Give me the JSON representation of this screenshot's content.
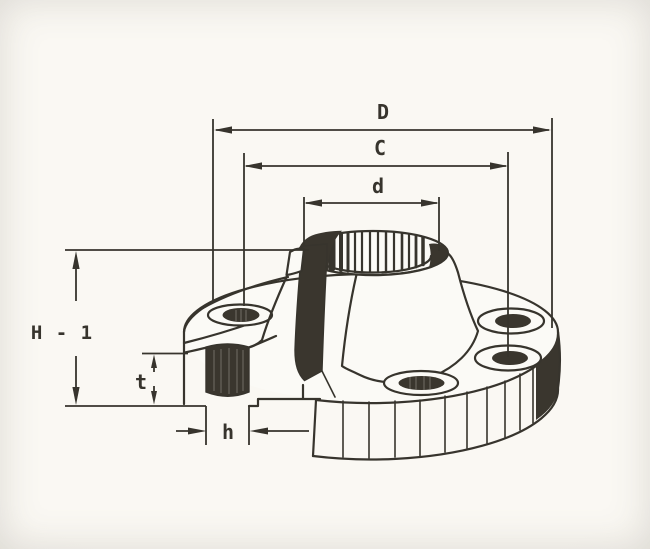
{
  "diagram": {
    "type": "technical-drawing",
    "subject": "flange-isometric-cutaway",
    "dimensions": [
      {
        "id": "D",
        "label": "D"
      },
      {
        "id": "C",
        "label": "C"
      },
      {
        "id": "d",
        "label": "d"
      },
      {
        "id": "H1",
        "label": "H - 1"
      },
      {
        "id": "t",
        "label": "t"
      },
      {
        "id": "h",
        "label": "h"
      }
    ],
    "colors": {
      "background": "#f8f6f0",
      "paper": "#fbfaf6",
      "ink": "#37342d",
      "section_fill": "#3a362e"
    }
  }
}
